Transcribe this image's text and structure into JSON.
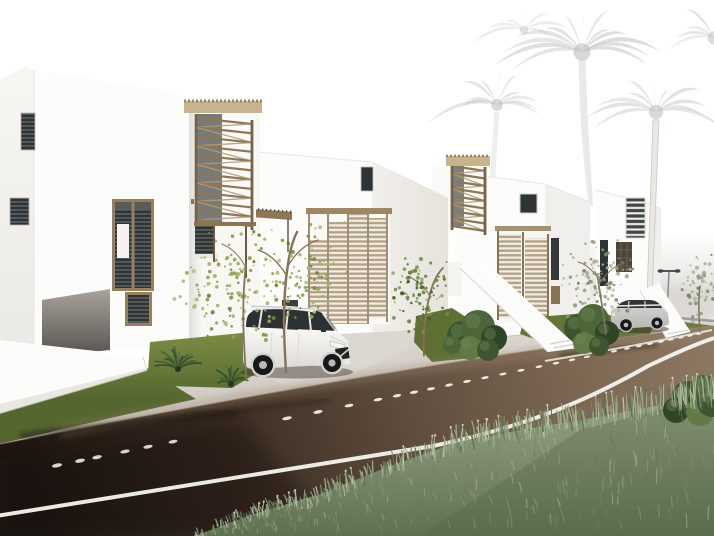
{
  "labels": {
    "scene": "Architectural rendering: row of white modern villas with wooden louver screens, palm trees, two parked cars and a dark asphalt road with foreground grass",
    "house_count": 4,
    "vehicles": [
      "white SUV",
      "silver wagon"
    ]
  },
  "colors": {
    "sky": "#ffffff",
    "palm": "#a9a9a6",
    "palm_trunk_lit": "#ebe8e4",
    "haze": "#cfccc7",
    "house_front": "#fcfcfa",
    "house_side": "#f1efeb",
    "panel": "#f8f7f4",
    "wood_dark": "#77634a",
    "wood_mid": "#8d7758",
    "wood_slat": "#b3a184",
    "thatch": "#c7b48f",
    "window_dark": "#2e3335",
    "frame_wood": "#96815f",
    "blind": "#f3f2ee",
    "concrete": "#d5d1ca",
    "driveway": "#dcd8d1",
    "lawn": "#71823d",
    "lawn_dark": "#5e7034",
    "marking": "#f7f4ee",
    "stud": "#d9d5cd",
    "car_white": "#f1f0ed",
    "car_glass": "#2c3134",
    "car_silver": "#cbcac7",
    "tire": "#17181a",
    "rim": "#b9b9b6",
    "tree_trunk": "#86715a",
    "shrub_green": "#2e4726"
  },
  "scene": {
    "palms": [
      {
        "cx": 497,
        "cy": 105,
        "r": 66,
        "n": 11,
        "o": 0.3,
        "seed": 7,
        "trunk": {
          "x1": 497,
          "y1": 112,
          "x2": 487,
          "y2": 300,
          "w": 5,
          "o": 0.2
        }
      },
      {
        "cx": 582,
        "cy": 52,
        "r": 96,
        "n": 13,
        "o": 0.33,
        "seed": 11,
        "trunk": {
          "x1": 582,
          "y1": 60,
          "x2": 591,
          "y2": 206,
          "w": 7,
          "o": 0.26
        }
      },
      {
        "cx": 656,
        "cy": 112,
        "r": 80,
        "n": 11,
        "o": 0.3,
        "seed": 23,
        "trunk": null
      },
      {
        "cx": 714,
        "cy": 38,
        "r": 72,
        "n": 9,
        "o": 0.26,
        "seed": 31,
        "trunk": null
      },
      {
        "cx": 524,
        "cy": 30,
        "r": 48,
        "n": 7,
        "o": 0.2,
        "seed": 41,
        "trunk": null
      }
    ],
    "zigzag": [
      {
        "x1": 196,
        "x2": 252,
        "y1": 118,
        "y2": 220,
        "n": 11,
        "dy": 6
      },
      {
        "x1": 452,
        "x2": 485,
        "y1": 166,
        "y2": 226,
        "n": 8,
        "dy": 5
      }
    ],
    "shrubs": [
      {
        "cx": 178,
        "cy": 369,
        "n": 16,
        "len": 21,
        "seed": 5
      },
      {
        "cx": 231,
        "cy": 384,
        "n": 14,
        "len": 18,
        "seed": 9
      }
    ],
    "bushes": {
      "b1": [
        [
          462,
          336,
          15
        ],
        [
          478,
          327,
          17
        ],
        [
          494,
          338,
          13
        ],
        [
          470,
          348,
          12
        ],
        [
          488,
          350,
          11
        ],
        [
          452,
          345,
          9
        ]
      ],
      "b2": [
        [
          578,
          328,
          14
        ],
        [
          593,
          320,
          16
        ],
        [
          607,
          333,
          12
        ],
        [
          584,
          343,
          11
        ],
        [
          599,
          346,
          10
        ]
      ],
      "b3": [
        [
          688,
          398,
          17
        ],
        [
          704,
          390,
          15
        ],
        [
          676,
          410,
          13
        ],
        [
          700,
          412,
          14
        ],
        [
          712,
          402,
          15
        ]
      ]
    },
    "bush_palette": [
      "#3d5430",
      "#4d6639",
      "#2f4525",
      "#617a45"
    ],
    "palettes": {
      "bright": [
        "#7d9a3f",
        "#93a855",
        "#6a8534",
        "#a8b56a"
      ],
      "dark": [
        "#55712e",
        "#6a8639",
        "#47601f",
        "#7c944d"
      ],
      "muted": [
        "#8a9878",
        "#9aa688",
        "#768563",
        "#a9b398"
      ]
    },
    "leaf_trees": [
      {
        "trunk": "M286,372 C284,340 282,302 288,264 C290,250 293,240 297,232",
        "branches": [
          "M288,266 C296,252 306,244 318,240",
          "M287,276 C278,262 270,254 258,250"
        ],
        "w": 2.4,
        "palette": "bright",
        "leaves": [
          {
            "cx": 256,
            "cy": 284,
            "rx": 80,
            "ry": 66,
            "n": 135
          },
          {
            "cx": 318,
            "cy": 266,
            "rx": 36,
            "ry": 50,
            "n": 50
          }
        ],
        "seed": 13
      },
      {
        "trunk": "M246,376 C244,346 241,306 246,264",
        "branches": [
          "M246,268 C240,256 232,248 222,244"
        ],
        "w": 1.8,
        "palette": "bright",
        "leaves": [
          {
            "cx": 214,
            "cy": 300,
            "rx": 44,
            "ry": 54,
            "n": 45
          }
        ],
        "seed": 17
      },
      {
        "trunk": "M424,356 C423,338 424,318 430,294 C433,282 437,274 443,268",
        "branches": [
          "M430,296 C424,286 416,280 408,276"
        ],
        "w": 1.8,
        "palette": "dark",
        "leaves": [
          {
            "cx": 422,
            "cy": 294,
            "rx": 36,
            "ry": 42,
            "n": 95
          }
        ],
        "seed": 19
      },
      {
        "trunk": "M606,334 C604,318 601,298 597,274",
        "branches": [
          "M598,278 C592,270 586,264 578,262",
          "M599,284 C606,274 612,268 620,264"
        ],
        "w": 1.7,
        "palette": "muted",
        "leaves": [
          {
            "cx": 599,
            "cy": 280,
            "rx": 40,
            "ry": 40,
            "n": 105
          }
        ],
        "seed": 29
      },
      {
        "trunk": "M700,332 C699,318 698,302 700,286",
        "branches": [],
        "w": 1.5,
        "palette": "muted",
        "leaves": [
          {
            "cx": 701,
            "cy": 288,
            "rx": 26,
            "ry": 36,
            "n": 60
          }
        ],
        "seed": 37
      }
    ],
    "grass": {
      "edge": [
        [
          195,
          536
        ],
        [
          250,
          515
        ],
        [
          320,
          494
        ],
        [
          390,
          466
        ],
        [
          455,
          443
        ],
        [
          525,
          429
        ],
        [
          592,
          418
        ],
        [
          660,
          405
        ],
        [
          714,
          396
        ]
      ],
      "palette": [
        "#6e8060",
        "#7f9170",
        "#92a282",
        "#a4b291",
        "#5c6e4e",
        "#b8c2a6"
      ],
      "light": "#c6cdb0",
      "n_edge": 430,
      "n_fill": 300,
      "n_stalk": 26,
      "seed": 77
    },
    "road": {
      "studs": [
        57,
        80,
        97,
        125,
        148,
        173
      ],
      "dashes": [
        287,
        318,
        349,
        378,
        397,
        414,
        431,
        449,
        467,
        485,
        503,
        521,
        539,
        556,
        572,
        587,
        601,
        614,
        627,
        639,
        650,
        661,
        671,
        681,
        690,
        699
      ],
      "x0": 64,
      "y0": 464,
      "slope": 0.205
    }
  }
}
